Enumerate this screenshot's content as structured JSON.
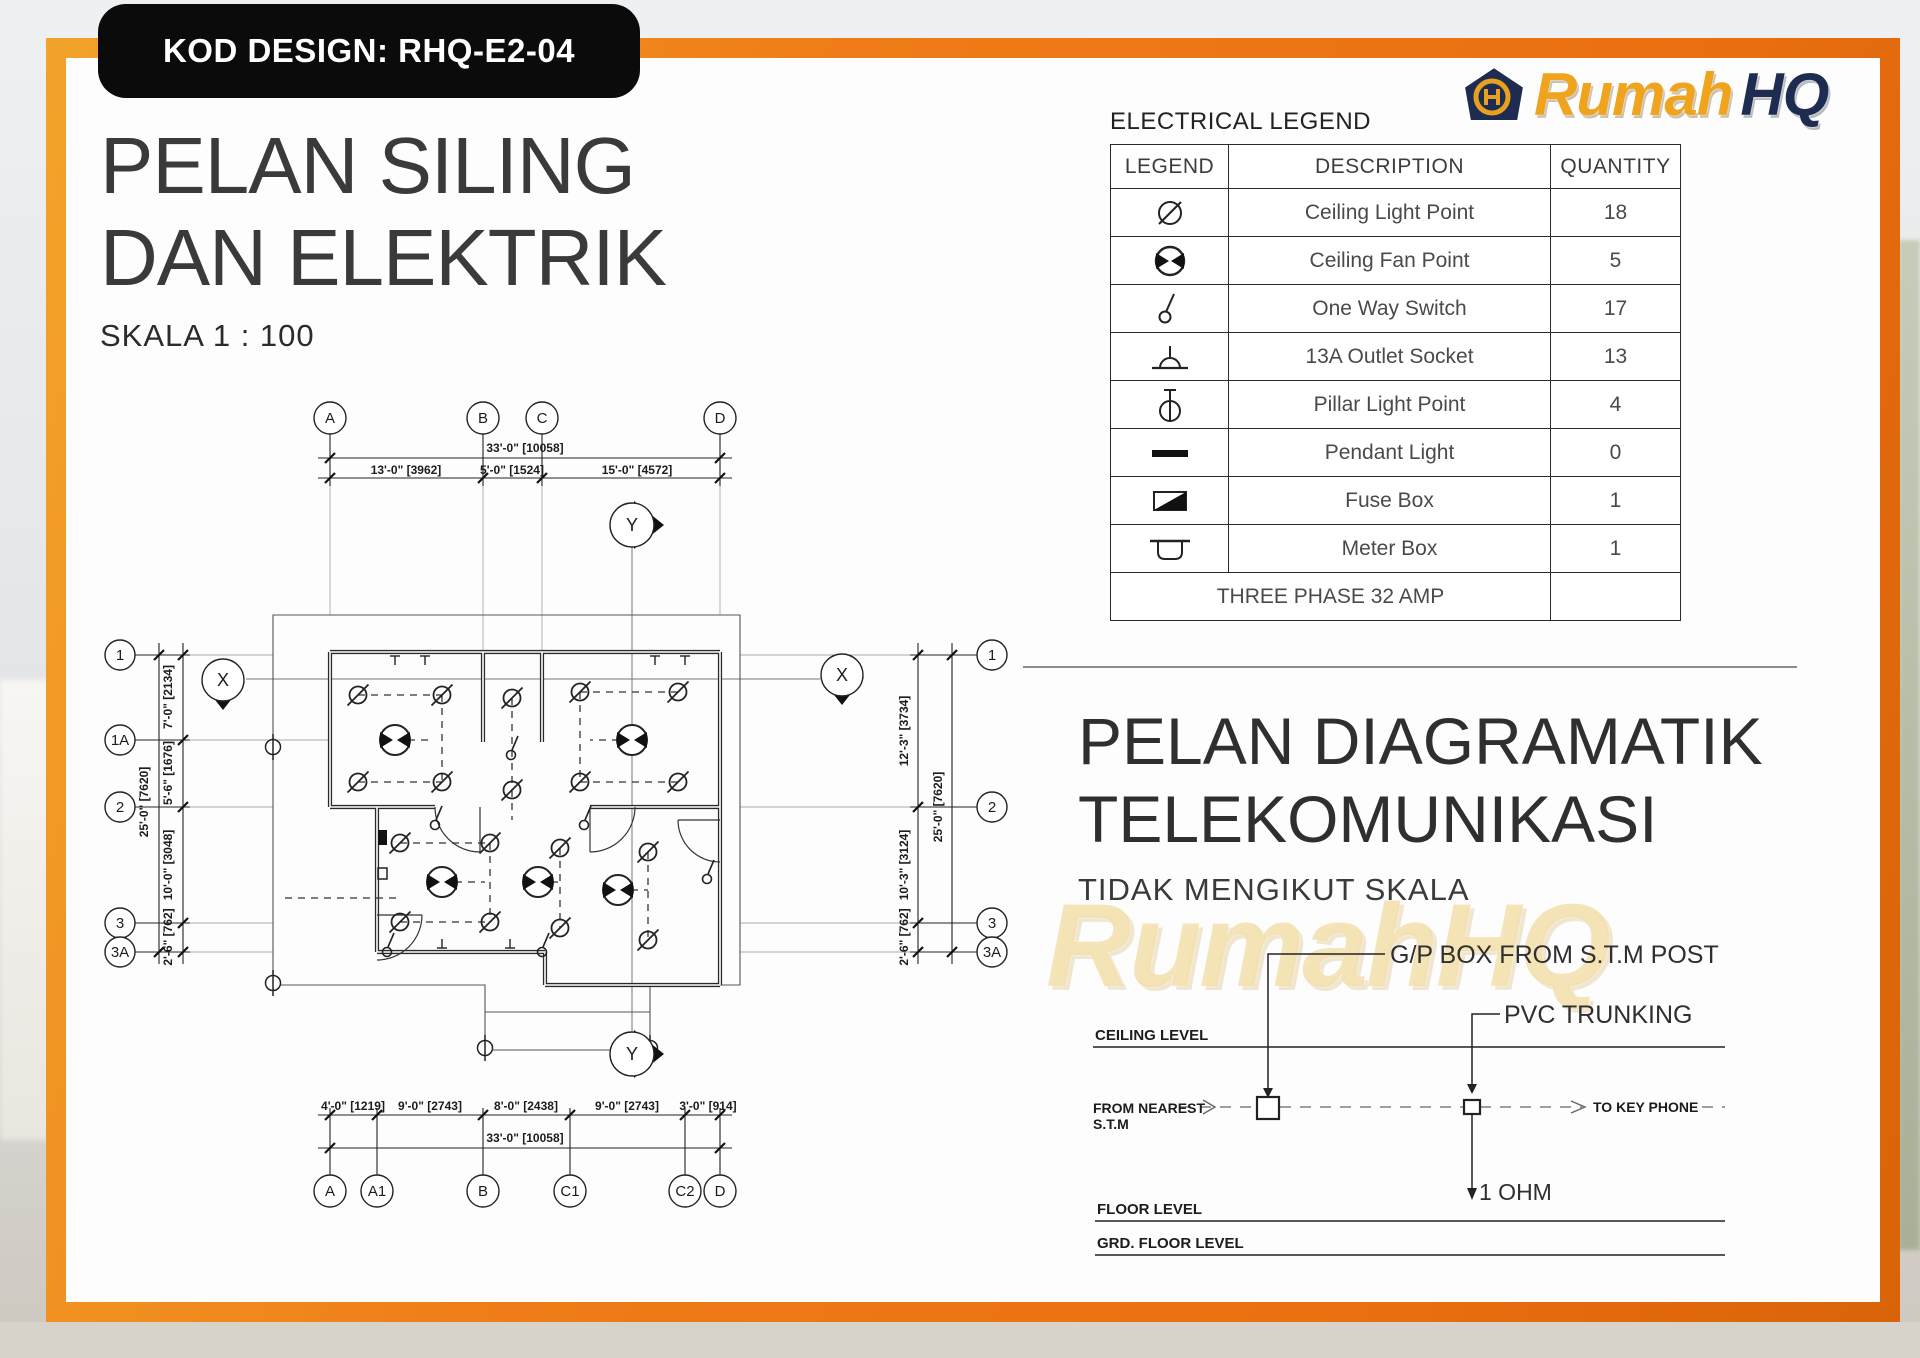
{
  "page": {
    "kod_design": "KOD DESIGN: RHQ-E2-04"
  },
  "colors": {
    "frame_orange": "#EF7D18",
    "badge_black": "#0B0B0B",
    "brand_gold": "#F0A31C",
    "brand_navy": "#1F2C52"
  },
  "brand": {
    "rumah": "Rumah",
    "hq": "HQ"
  },
  "title": {
    "line1": "PELAN SILING",
    "line2": "DAN ELEKTRIK",
    "scale": "SKALA 1 : 100"
  },
  "legend_table": {
    "title": "ELECTRICAL LEGEND",
    "headers": [
      "LEGEND",
      "DESCRIPTION",
      "QUANTITY"
    ],
    "rows": [
      {
        "symbol": "ceiling-light-symbol",
        "description": "Ceiling Light Point",
        "quantity": "18"
      },
      {
        "symbol": "ceiling-fan-symbol",
        "description": "Ceiling Fan Point",
        "quantity": "5"
      },
      {
        "symbol": "one-way-switch-symbol",
        "description": "One Way Switch",
        "quantity": "17"
      },
      {
        "symbol": "outlet-socket-symbol",
        "description": "13A Outlet Socket",
        "quantity": "13"
      },
      {
        "symbol": "pillar-light-symbol",
        "description": "Pillar Light Point",
        "quantity": "4"
      },
      {
        "symbol": "pendant-light-symbol",
        "description": "Pendant Light",
        "quantity": "0"
      },
      {
        "symbol": "fuse-box-symbol",
        "description": "Fuse Box",
        "quantity": "1"
      },
      {
        "symbol": "meter-box-symbol",
        "description": "Meter Box",
        "quantity": "1"
      }
    ],
    "footer": "THREE PHASE 32 AMP"
  },
  "plan": {
    "grid_top": [
      "A",
      "B",
      "C",
      "D"
    ],
    "grid_bottom": [
      "A",
      "A1",
      "B",
      "C1",
      "C2",
      "D"
    ],
    "grid_left": [
      "1",
      "1A",
      "2",
      "3",
      "3A"
    ],
    "grid_right": [
      "1",
      "2",
      "3",
      "3A"
    ],
    "section": {
      "x": "X",
      "y": "Y"
    },
    "dims_top": {
      "overall": "33'-0\" [10058]",
      "segments": [
        "13'-0\" [3962]",
        "5'-0\" [1524]",
        "15'-0\" [4572]"
      ]
    },
    "dims_bottom": {
      "overall": "33'-0\" [10058]",
      "segments": [
        "4'-0\" [1219]",
        "9'-0\" [2743]",
        "8'-0\" [2438]",
        "9'-0\" [2743]",
        "3'-0\" [914]"
      ]
    },
    "dims_left": {
      "overall": "25'-0\" [7620]",
      "segments": [
        "7'-0\" [2134]",
        "5'-6\" [1676]",
        "10'-0\" [3048]",
        "2'-6\" [762]"
      ]
    },
    "dims_right": {
      "overall": "25'-0\" [7620]",
      "segments": [
        "12'-3\" [3734]",
        "10'-3\" [3124]",
        "2'-6\" [762]"
      ]
    }
  },
  "telecom": {
    "title_line1": "PELAN DIAGRAMATIK",
    "title_line2": "TELEKOMUNIKASI",
    "subtitle": "TIDAK MENGIKUT SKALA",
    "watermark": "RumahHQ",
    "labels": {
      "gp_box": "G/P BOX FROM  S.T.M  POST",
      "pvc": "PVC TRUNKING",
      "ceiling": "CEILING LEVEL",
      "from1": "FROM NEAREST",
      "from2": "S.T.M",
      "to": "TO KEY PHONE",
      "ohm": "1 OHM",
      "floor": "FLOOR LEVEL",
      "grd": "GRD. FLOOR LEVEL"
    }
  }
}
